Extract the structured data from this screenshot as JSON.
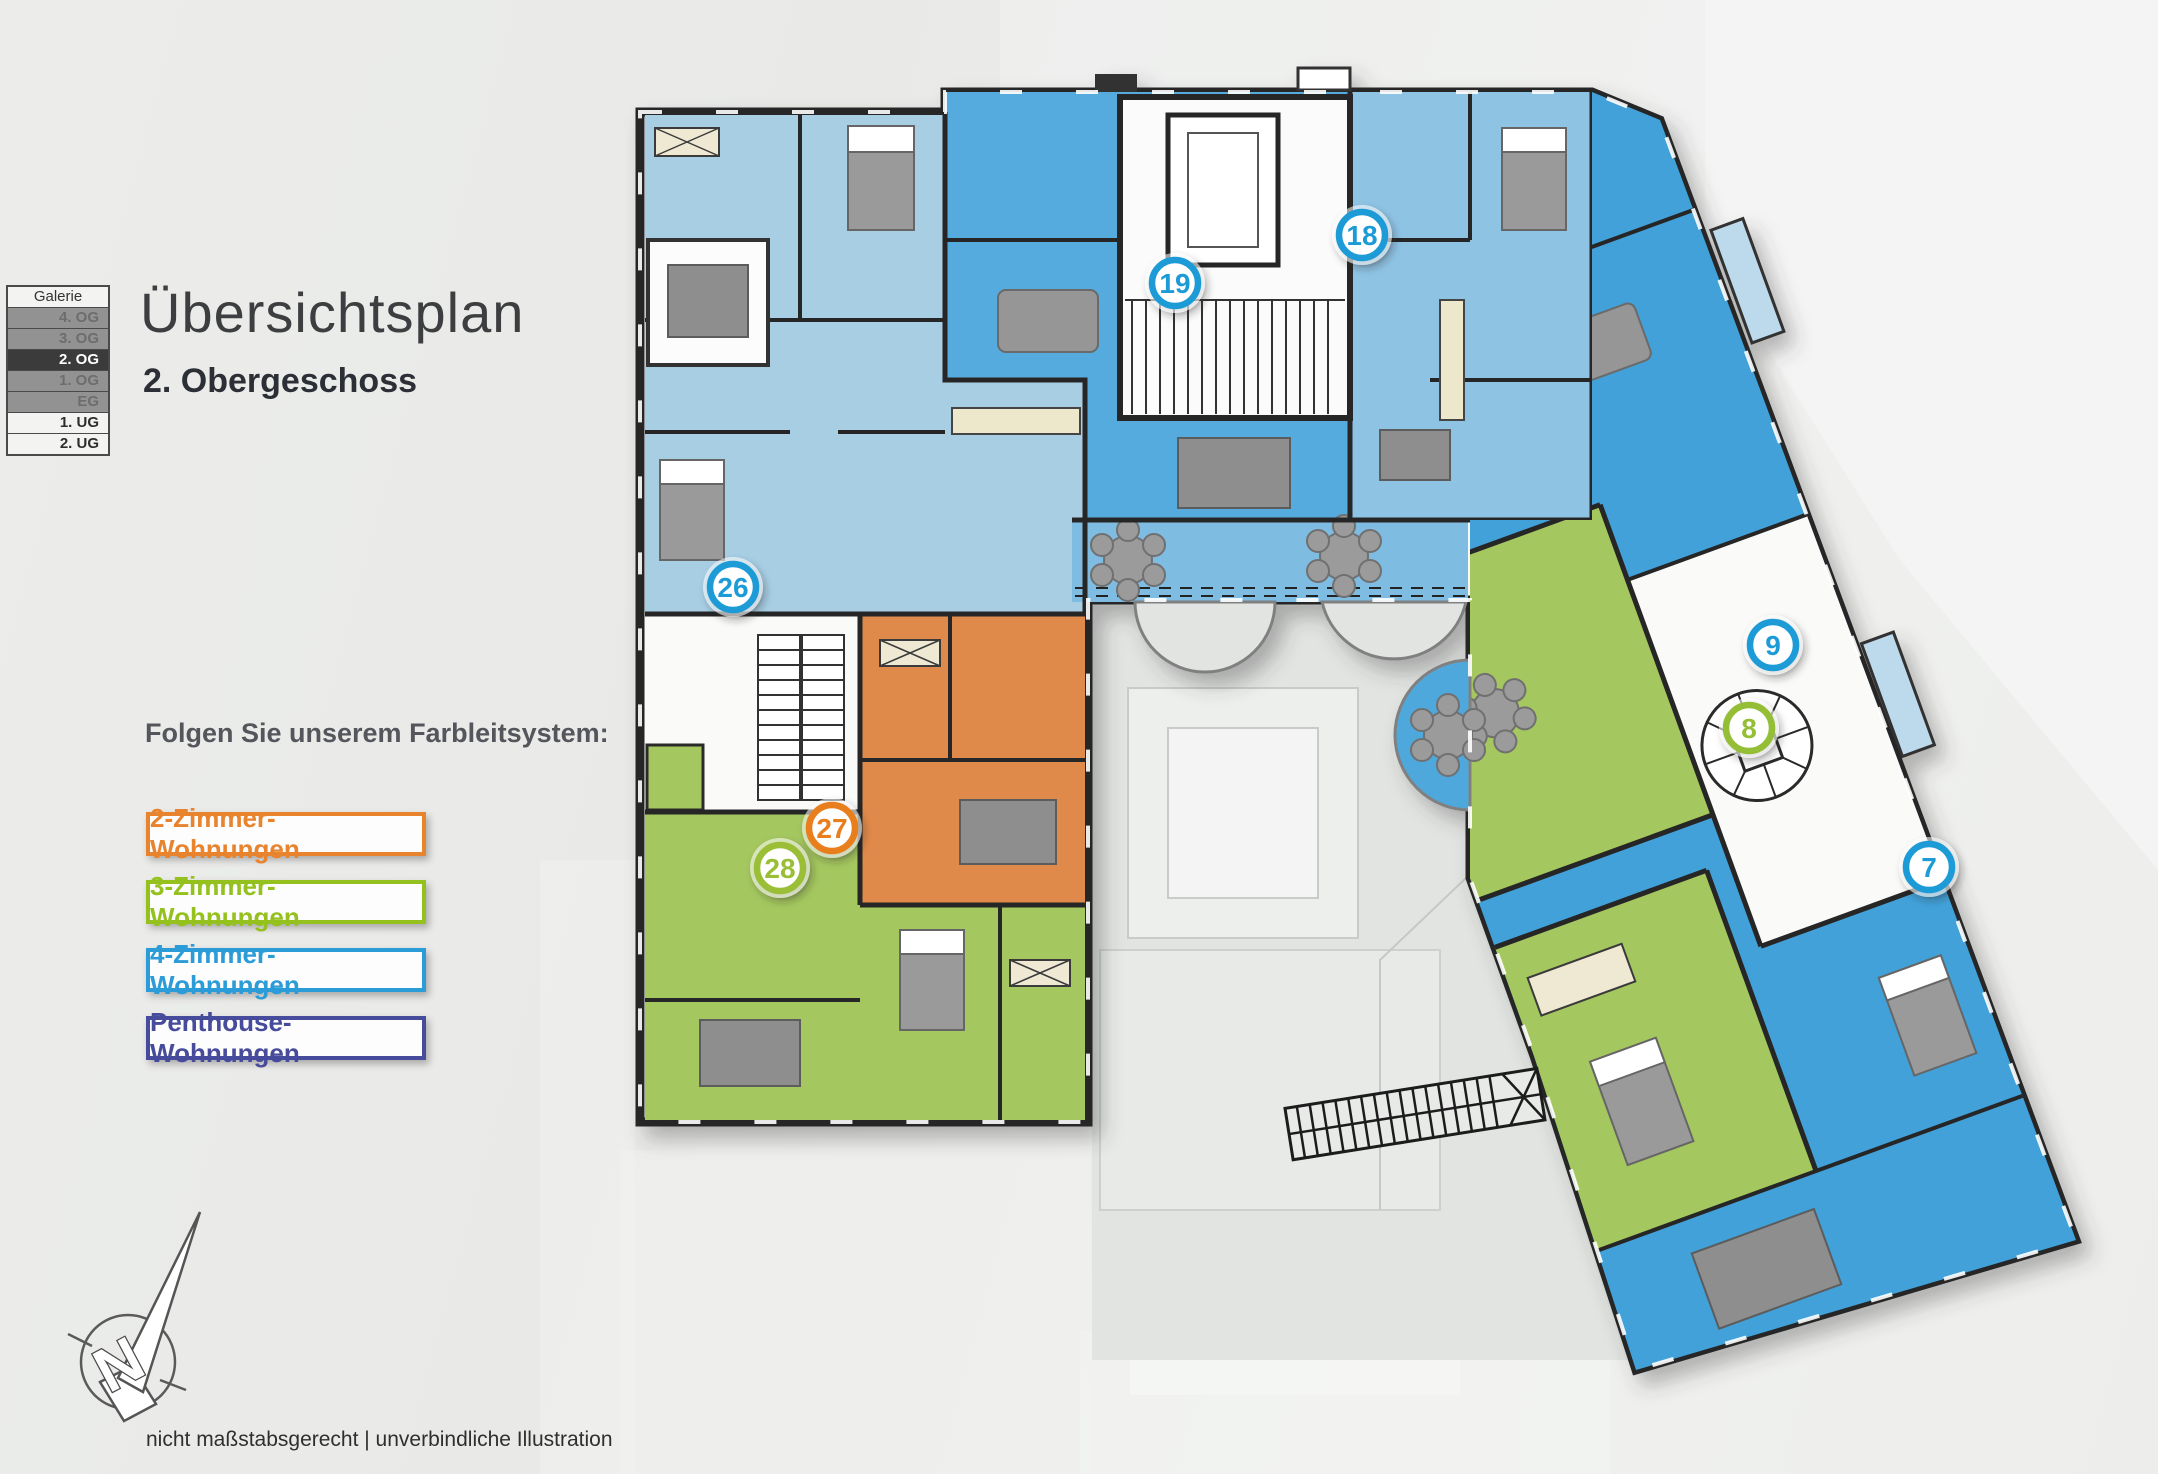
{
  "page": {
    "title": "Übersichtsplan",
    "subtitle": "2. Obergeschoss",
    "legend_intro": "Folgen Sie unserem Farbleitsystem:",
    "footnote": "nicht maßstabsgerecht | unverbindliche Illustration"
  },
  "floor_selector": {
    "items": [
      {
        "label": "Galerie",
        "state": "plain"
      },
      {
        "label": "4. OG",
        "state": "dim"
      },
      {
        "label": "3. OG",
        "state": "dim"
      },
      {
        "label": "2. OG",
        "state": "active"
      },
      {
        "label": "1. OG",
        "state": "dim"
      },
      {
        "label": "EG",
        "state": "dim"
      },
      {
        "label": "1. UG",
        "state": "light"
      },
      {
        "label": "2. UG",
        "state": "light"
      }
    ]
  },
  "legend": {
    "items": [
      {
        "label": "2-Zimmer-Wohnungen",
        "color": "#e8832e"
      },
      {
        "label": "3-Zimmer-Wohnungen",
        "color": "#95c11f"
      },
      {
        "label": "4-Zimmer-Wohnungen",
        "color": "#2b9cd8"
      },
      {
        "label": "Penthouse-Wohnungen",
        "color": "#474b9b"
      }
    ]
  },
  "plan": {
    "compass_letter": "N",
    "units": [
      {
        "number": "7",
        "color": "#1e9bd7",
        "x": 1929,
        "y": 867
      },
      {
        "number": "8",
        "color": "#94be34",
        "x": 1749,
        "y": 728
      },
      {
        "number": "9",
        "color": "#1e9bd7",
        "x": 1773,
        "y": 645
      },
      {
        "number": "18",
        "color": "#1e9bd7",
        "x": 1362,
        "y": 235
      },
      {
        "number": "19",
        "color": "#1e9bd7",
        "x": 1175,
        "y": 283
      },
      {
        "number": "26",
        "color": "#1e9bd7",
        "x": 733,
        "y": 587
      },
      {
        "number": "27",
        "color": "#e87e1f",
        "x": 832,
        "y": 828
      },
      {
        "number": "28",
        "color": "#9abe35",
        "x": 780,
        "y": 868
      }
    ]
  }
}
